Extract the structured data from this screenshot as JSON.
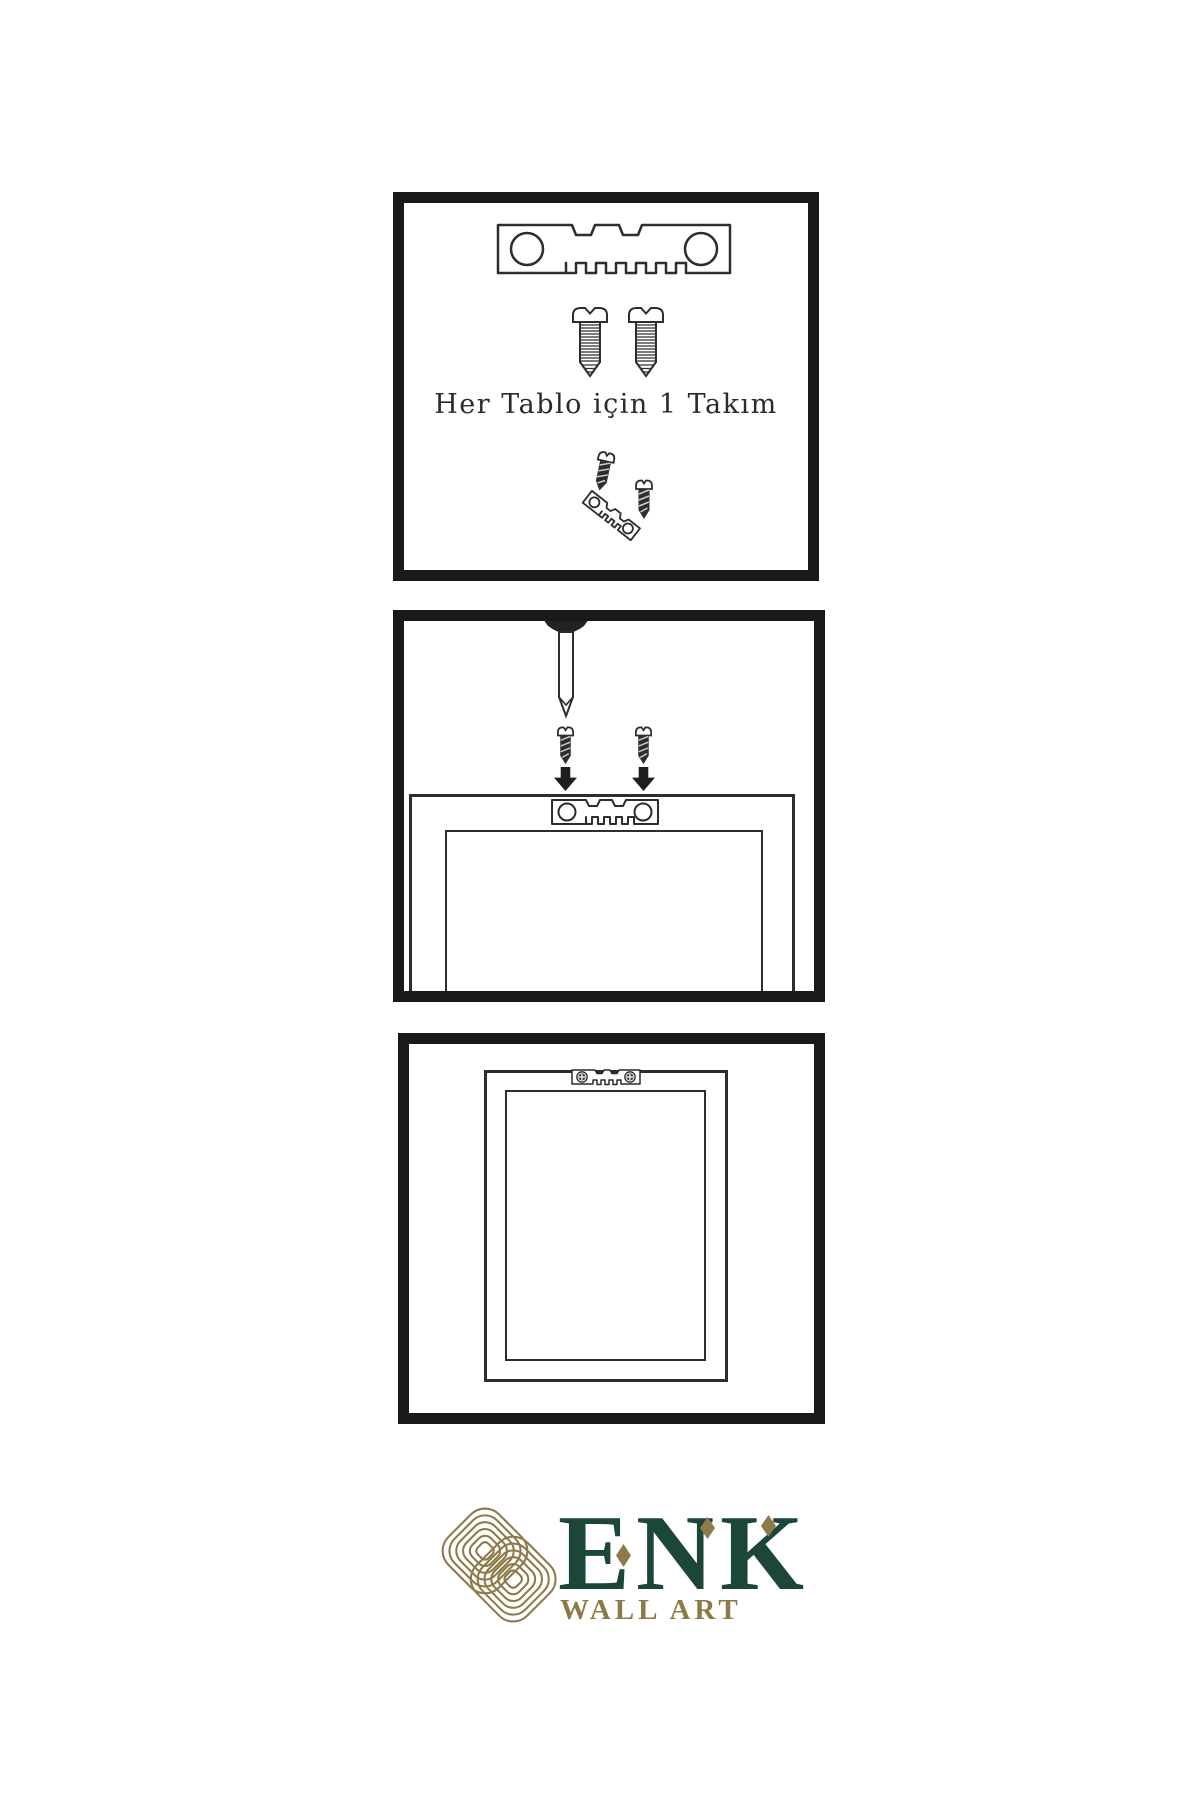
{
  "document": {
    "kind": "wall-art-hanging-instructions",
    "background": "#ffffff"
  },
  "colors": {
    "line": "#2d2d2d",
    "panel_border": "#191919",
    "dark_metal": "#2e2e2e",
    "logo_green": "#1b4639",
    "logo_gold": "#8c7a49",
    "caption_text": "#2b2b2b"
  },
  "panels": {
    "step1": {
      "caption": "Her Tablo için 1 Takım",
      "icons": [
        "sawtooth-hanger-icon",
        "screw-icon",
        "screw-icon",
        "screw-into-tilted-hanger-icon"
      ]
    },
    "step2": {
      "icons": [
        "nail-in-wall-icon",
        "dark-screw-icon",
        "down-arrow-icon",
        "dark-screw-icon",
        "down-arrow-icon",
        "frame-back-with-sawtooth-hanger-icon"
      ]
    },
    "step3": {
      "icons": [
        "hanging-frame-icon",
        "mounted-sawtooth-hanger-with-screws-icon"
      ]
    }
  },
  "logo": {
    "mark": "interlaced-knot-icon",
    "title": "ENK",
    "subtitle": "WALL ART"
  }
}
